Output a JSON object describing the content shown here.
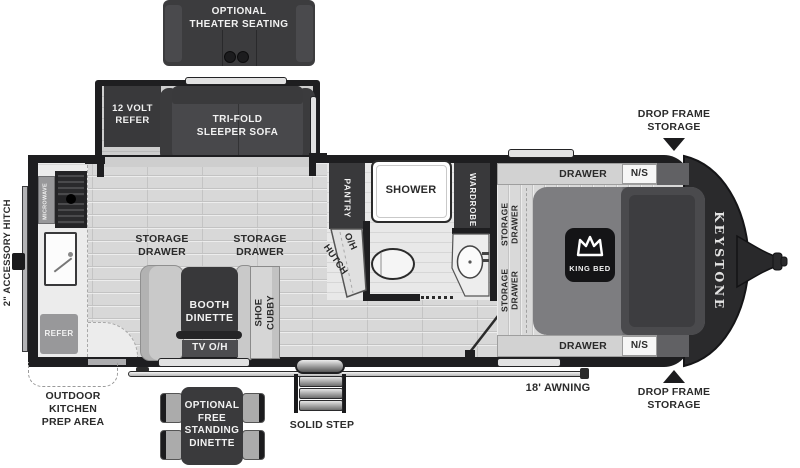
{
  "slides": {
    "theater": {
      "label": "OPTIONAL\nTHEATER SEATING"
    },
    "sofa_slide": {
      "refer12v": "12 VOLT\nREFER",
      "sofa": "TRI-FOLD\nSLEEPER SOFA"
    }
  },
  "galley": {
    "microwave": "MICROWAVE",
    "refer": "REFER",
    "storage_drawer_left": "STORAGE\nDRAWER",
    "storage_drawer_right": "STORAGE\nDRAWER",
    "booth_dinette": "BOOTH\nDINETTE",
    "tv_overhead": "TV O/H",
    "shoe_cubby": "SHOE\nCUBBY"
  },
  "bath": {
    "pantry": "PANTRY",
    "shower": "SHOWER",
    "wardrobe": "WARDROBE",
    "hutch": "HUTCH",
    "overhead": "O/H"
  },
  "bedroom": {
    "storage_drawer_upper": "STORAGE\nDRAWER",
    "storage_drawer_lower": "STORAGE\nDRAWER",
    "drawer_top": "DRAWER",
    "drawer_bottom": "DRAWER",
    "nightstand_top": "N/S",
    "nightstand_bottom": "N/S",
    "king_bed": "KING BED"
  },
  "exterior": {
    "accessory_hitch": "2\" ACCESSORY HITCH",
    "outdoor_kitchen": "OUTDOOR\nKITCHEN\nPREP AREA",
    "free_standing_dinette": "OPTIONAL\nFREE\nSTANDING\nDINETTE",
    "solid_step": "SOLID STEP",
    "awning": "18'  AWNING",
    "drop_frame_top": "DROP FRAME\nSTORAGE",
    "drop_frame_bottom": "DROP FRAME\nSTORAGE",
    "brand": "KEYSTONE"
  },
  "colors": {
    "wall": "#1e1e20",
    "dark_furniture": "#3e3e40",
    "floor": "#d8d8d8",
    "appliance_gray": "#98989a",
    "front_cap": "#2a2a2c"
  }
}
